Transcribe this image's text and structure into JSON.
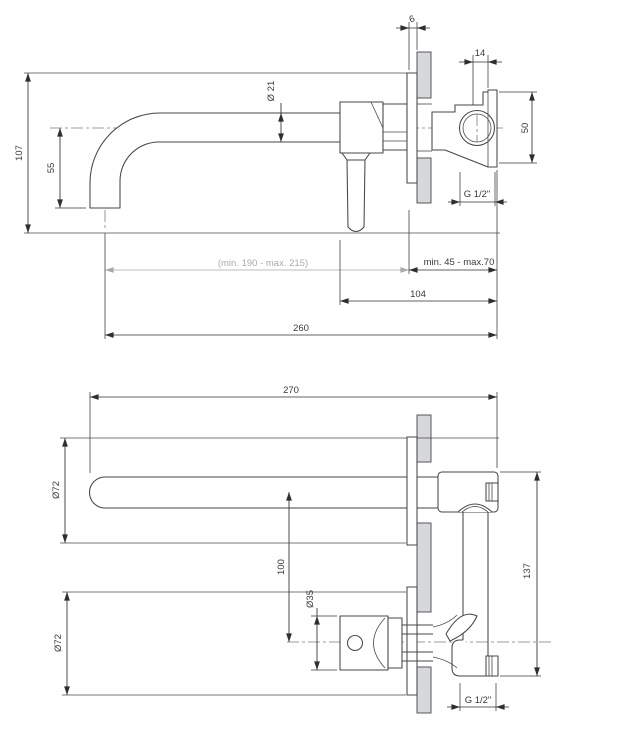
{
  "meta": {
    "title": "Wall-mounted basin mixer tap — dimensional technical drawing with two orthographic views"
  },
  "colors": {
    "line": "#464646",
    "dimension": "#2f2f2f",
    "gray_dimension": "#a9a9a9",
    "centerline": "#7d7d7d",
    "wall_fill": "#d6d8db",
    "background": "#ffffff"
  },
  "side_view": {
    "name": "side elevation (spout and concealed valve through wall)",
    "dims": {
      "height_total": "107",
      "spout_drop": "55",
      "spout_diameter": "Ø 21",
      "plate_thickness": "6",
      "port_offset": "14",
      "valve_height": "50",
      "thread": "G 1/2\"",
      "spout_reach_range": "(min. 190 - max. 215)",
      "install_depth_range": "min. 45 - max.70",
      "body_depth": "104",
      "overall_reach": "260"
    }
  },
  "plan_view": {
    "name": "plan view (spout, handle and concealed body)",
    "dims": {
      "overall_depth": "270",
      "spout_rosette_diameter": "Ø72",
      "axis_spacing": "100",
      "handle_diameter": "Ø35",
      "handle_rosette_diameter": "Ø72",
      "valve_span": "137",
      "thread": "G 1/2\""
    }
  }
}
